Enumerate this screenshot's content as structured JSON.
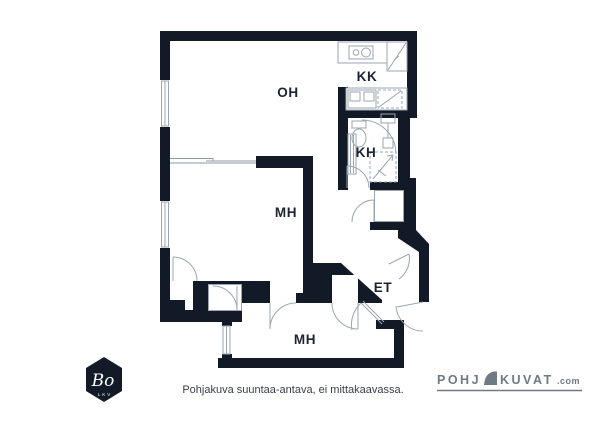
{
  "plan": {
    "rooms": [
      {
        "id": "oh",
        "label": "OH"
      },
      {
        "id": "kk",
        "label": "KK"
      },
      {
        "id": "kh",
        "label": "KH"
      },
      {
        "id": "mh1",
        "label": "MH"
      },
      {
        "id": "et",
        "label": "ET"
      },
      {
        "id": "mh2",
        "label": "MH"
      }
    ],
    "caption": "Pohjakuva suuntaa-antava, ei mittakaavassa."
  },
  "branding": {
    "bo_logo": {
      "name": "Bo",
      "sub": "LKV"
    },
    "pohjakuvat_logo": {
      "part1": "POHJ",
      "part2": "KUVAT",
      "suffix": ".com"
    }
  },
  "colors": {
    "wall": "#111a26",
    "thin_line": "#9aa6b2",
    "label_text": "#1b2430",
    "logo_gray": "#6e7b85"
  }
}
